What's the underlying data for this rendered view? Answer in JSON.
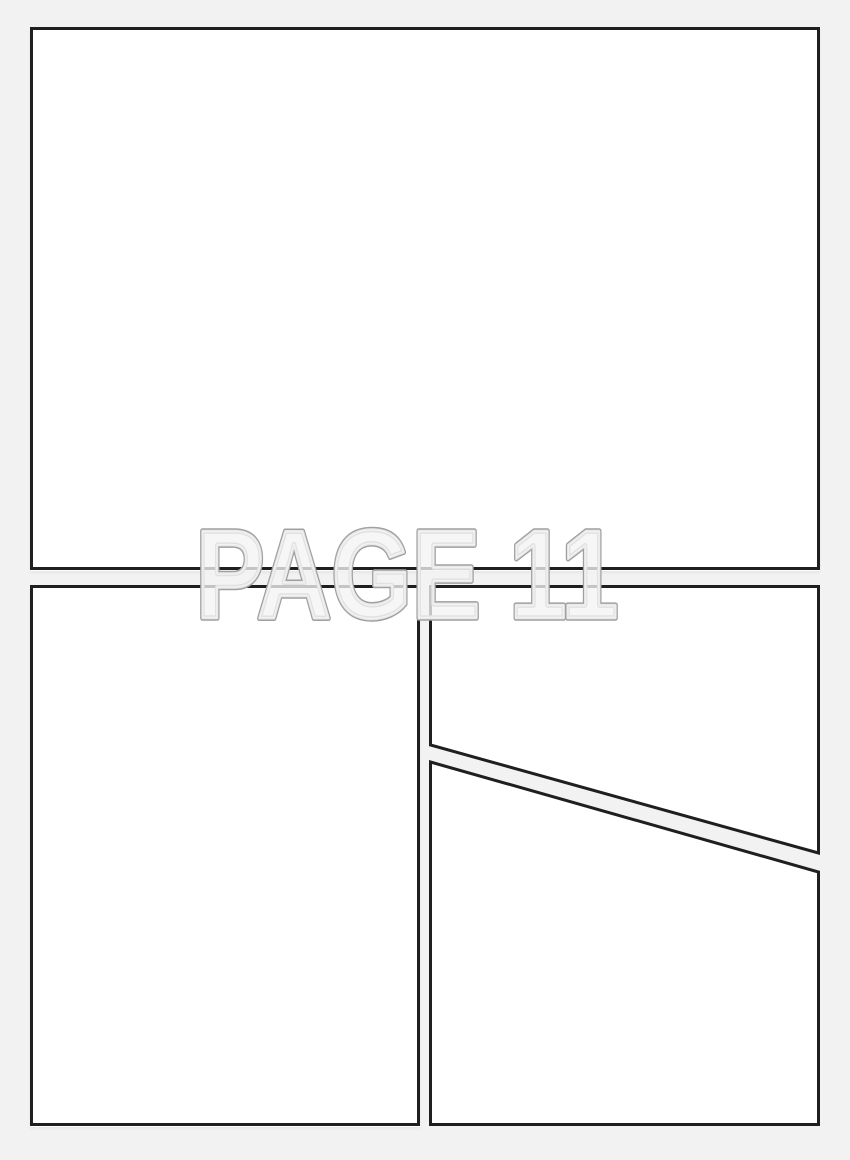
{
  "watermark": {
    "text": "PAGE 11"
  },
  "colors": {
    "page_background": "#f2f2f2",
    "panel_fill": "#ffffff",
    "panel_border": "#1f1f1f",
    "watermark_outline": "#a0a0a0",
    "watermark_fill": "#f4f4f4"
  }
}
